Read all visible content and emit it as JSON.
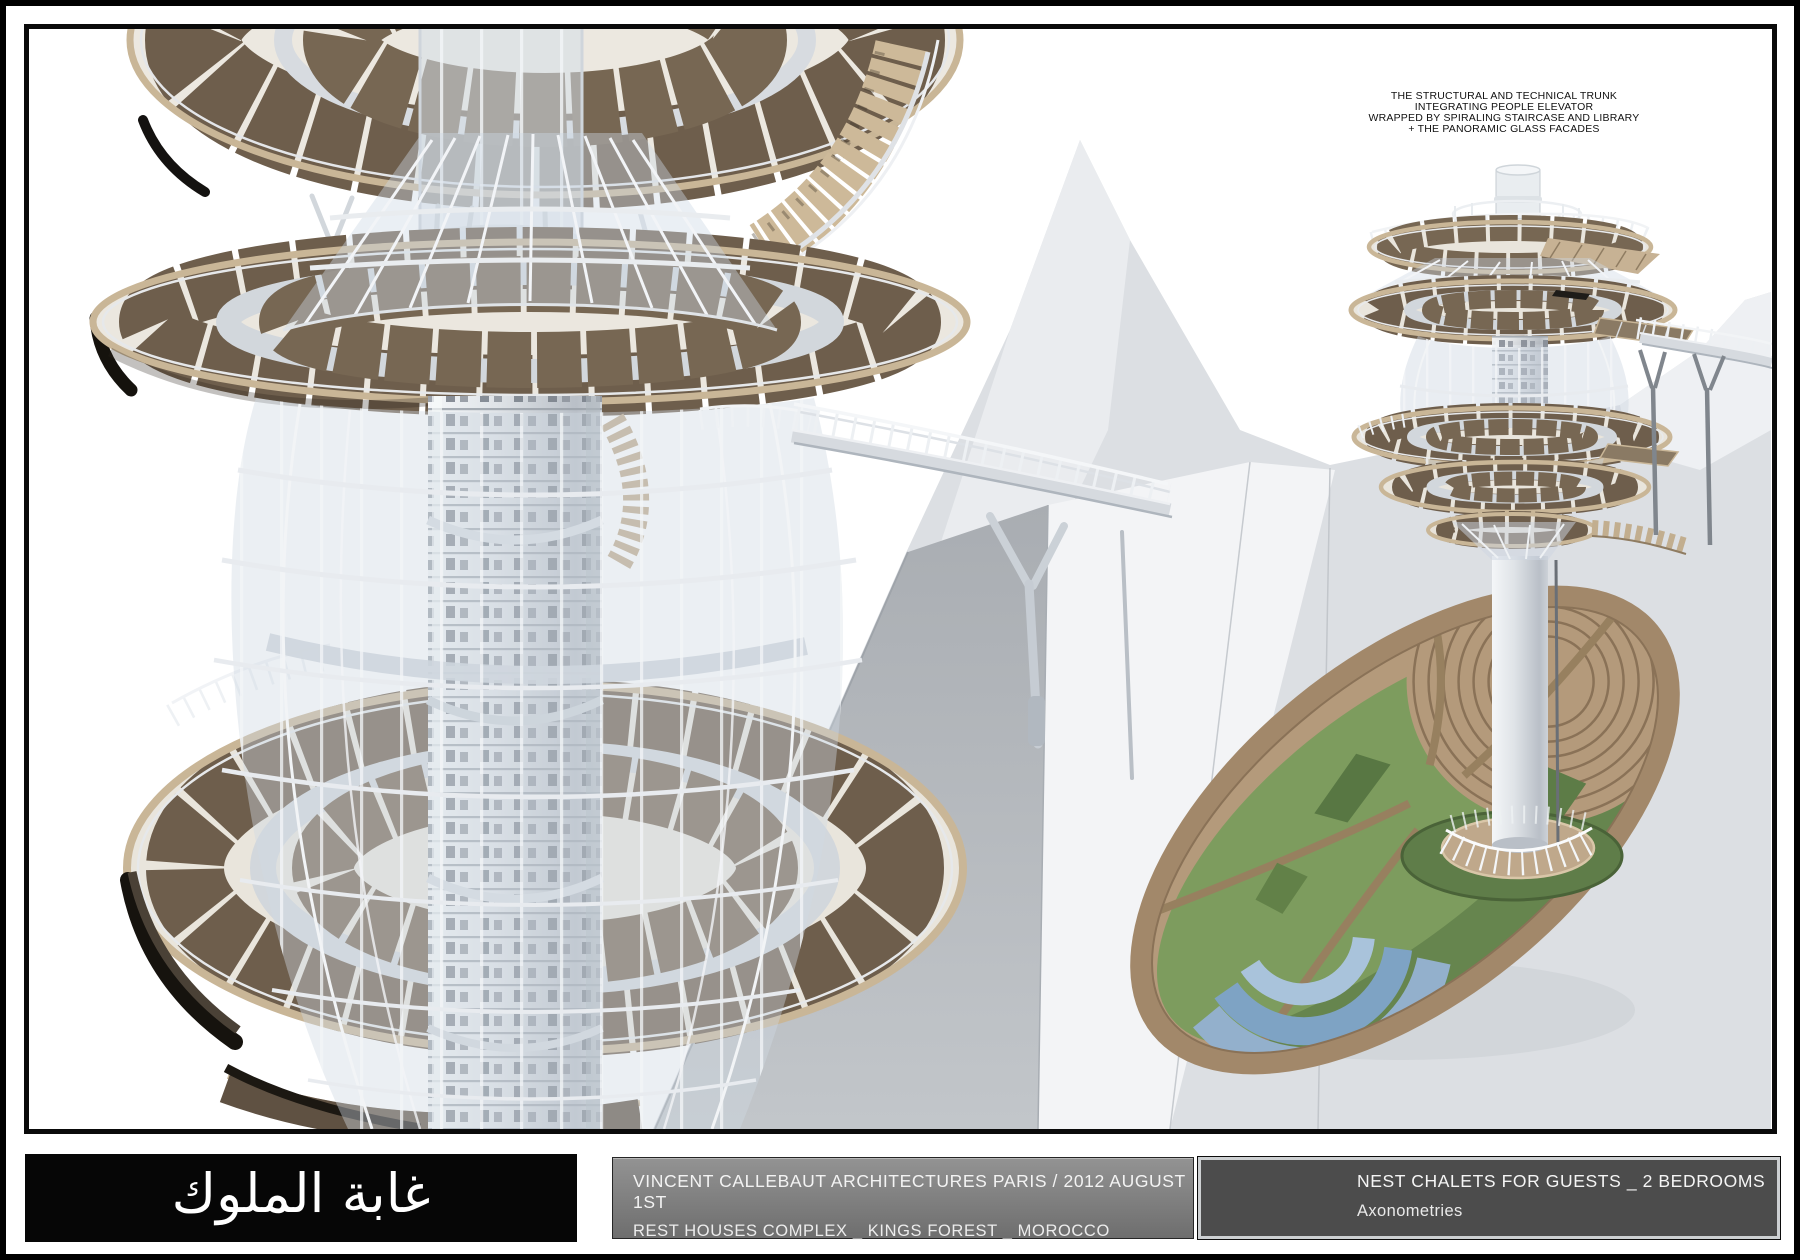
{
  "annotation": {
    "lines": [
      "THE STRUCTURAL AND TECHNICAL TRUNK",
      "INTEGRATING PEOPLE ELEVATOR",
      "WRAPPED BY SPIRALING STAIRCASE AND LIBRARY",
      "+ THE PANORAMIC GLASS FACADES"
    ]
  },
  "title_block": {
    "project_title_arabic": "غابة الملوك",
    "studio_line": "VINCENT CALLEBAUT ARCHITECTURES PARIS / 2012 AUGUST 1ST",
    "project_line": "REST HOUSES COMPLEX _ KINGS FOREST _ MOROCCO",
    "sheet_line": "NEST CHALETS FOR GUESTS _ 2 BEDROOMS",
    "sheet_subline": "Axonometries"
  },
  "colors": {
    "annotation_text": "#111111",
    "title_box_black": "#060606",
    "credit_box_gray": "#868686",
    "sheet_box_gray": "#4c4c4c",
    "deck_plank": "#6e5e4c",
    "deck_plank_light": "#776753",
    "deck_rim_tan": "#c9b697",
    "steel_silver": "#d2d7dc",
    "glass_tint": "#cfd8e3",
    "ground_gray": "#b7bbc0",
    "ground_pale": "#f3f4f6",
    "terrace_green": "#7d9c5e",
    "terrace_green_dark": "#5f7d49",
    "pool_blue": "#7ea3c4",
    "leaf_rim_brown": "#a2886a",
    "leaf_inner_tan": "#b49a7b"
  }
}
